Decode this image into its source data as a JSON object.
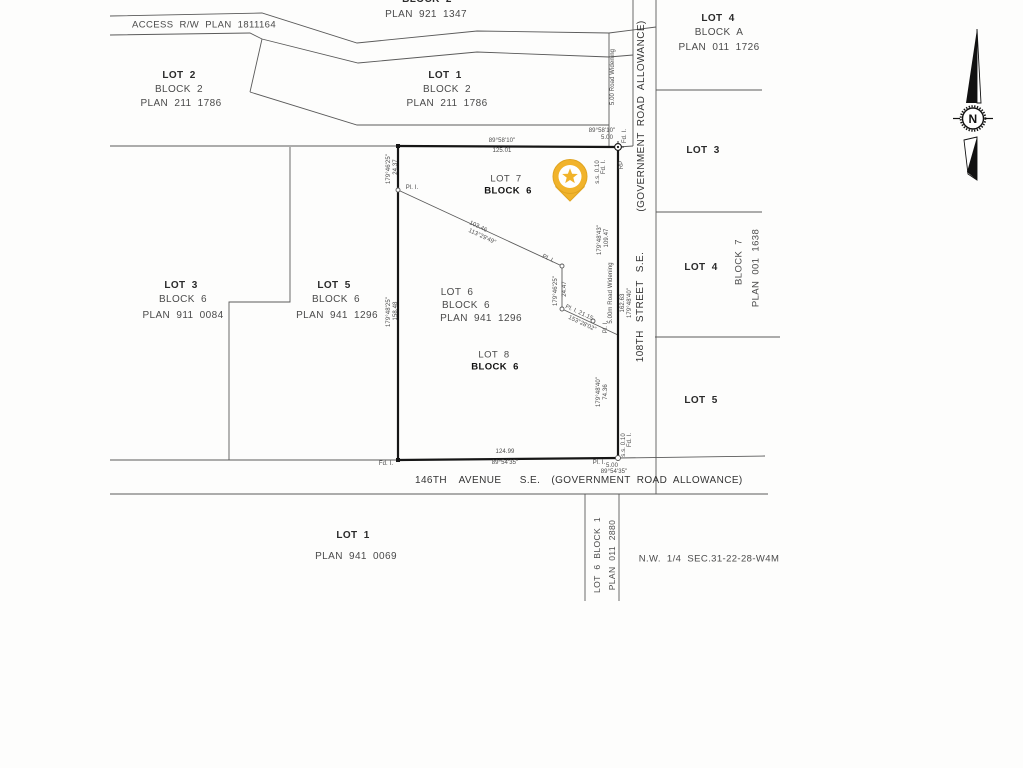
{
  "colors": {
    "thin_line": "#5a5a5a",
    "bold_line": "#161616",
    "text": "#4a4a4a",
    "pin_fill": "#F1B32B",
    "pin_edge": "#E0A420",
    "pin_inner": "#FFFFFF",
    "background": "#fdfdfc"
  },
  "compass": {
    "label": "N"
  },
  "pin": {
    "cx": 570,
    "cy": 176.5,
    "r": 17,
    "inner_r": 11.5,
    "tail": "556,187 584,187 570,201",
    "star": "570,168.3 572.1,173.7 577.8,174 573.3,177.6 574.8,183.1 570,180 565.2,183.1 566.7,177.6 562.2,174 567.9,173.7"
  },
  "geometry": {
    "thin": [
      [
        110,
        16,
        262,
        13,
        357,
        43,
        477,
        31,
        609,
        33,
        656,
        27
      ],
      [
        110,
        35,
        250,
        33,
        262,
        39,
        358,
        63,
        477,
        52,
        609,
        57,
        633,
        55
      ],
      [
        262,
        39,
        250,
        92
      ],
      [
        250,
        92,
        357,
        125,
        609,
        125
      ],
      [
        609,
        33,
        609,
        146
      ],
      [
        633,
        0,
        633,
        146
      ],
      [
        656,
        0,
        656,
        494
      ],
      [
        110,
        146,
        398,
        146
      ],
      [
        290,
        147,
        290,
        302,
        229,
        302,
        229,
        460
      ],
      [
        110,
        460,
        398,
        460
      ],
      [
        618,
        458,
        765,
        456
      ],
      [
        618,
        147,
        633,
        146
      ],
      [
        110,
        494,
        768,
        494
      ],
      [
        585,
        494,
        585,
        601
      ],
      [
        619,
        494,
        619,
        601
      ],
      [
        656,
        90,
        762,
        90
      ],
      [
        656,
        212,
        762,
        212
      ],
      [
        655,
        337,
        780,
        337
      ],
      [
        398,
        190,
        562,
        266,
        562,
        309,
        618,
        335
      ]
    ],
    "bold": [
      [
        398,
        146,
        618,
        147
      ],
      [
        618,
        147,
        618,
        458
      ],
      [
        398,
        460,
        618,
        458
      ],
      [
        398,
        146,
        398,
        460
      ]
    ],
    "circles": [
      [
        398,
        190,
        2
      ],
      [
        562,
        266,
        2
      ],
      [
        562,
        309,
        2
      ],
      [
        593,
        321,
        2
      ],
      [
        618,
        458,
        2.5
      ]
    ],
    "squares": [
      [
        398,
        146
      ],
      [
        398,
        460
      ]
    ],
    "monument": {
      "x": 618,
      "y": 147
    },
    "compass": {
      "top_black": "977,29 966,103 977,103",
      "top_outline": "977,29 981,103 977,103",
      "bottom_outline": "964,140 977,137 977,180 968,174",
      "bottom_black": "977,137 977,180 967,172",
      "circle": {
        "cx": 973,
        "cy": 118.5,
        "r": 10.5,
        "serr_r": 12.3
      },
      "dashes": [
        [
          953,
          118.5,
          960,
          118.5
        ],
        [
          986,
          118.5,
          993,
          118.5
        ]
      ]
    }
  },
  "labels": [
    {
      "n": "block2-top-label",
      "t": "BLOCK 2",
      "x": 427,
      "y": 0,
      "fs": 10,
      "b": 1
    },
    {
      "n": "plan-921-1347-label",
      "t": "PLAN 921 1347",
      "x": 426,
      "y": 15,
      "fs": 10
    },
    {
      "n": "access-rw-label",
      "t": "ACCESS R/W PLAN 1811164",
      "x": 204,
      "y": 25,
      "fs": 9.5
    },
    {
      "n": "lot2-title",
      "t": "LOT 2",
      "x": 179,
      "y": 76,
      "fs": 10,
      "b": 1
    },
    {
      "n": "lot2-block",
      "t": "BLOCK 2",
      "x": 179,
      "y": 89.5,
      "fs": 10
    },
    {
      "n": "lot2-plan",
      "t": "PLAN 211 1786",
      "x": 181,
      "y": 104,
      "fs": 10
    },
    {
      "n": "lot1-title",
      "t": "LOT 1",
      "x": 445,
      "y": 76,
      "fs": 10,
      "b": 1
    },
    {
      "n": "lot1-block",
      "t": "BLOCK 2",
      "x": 447,
      "y": 89.5,
      "fs": 10
    },
    {
      "n": "lot1-plan",
      "t": "PLAN 211 1786",
      "x": 447,
      "y": 104,
      "fs": 10
    },
    {
      "n": "lot4a-title",
      "t": "LOT 4",
      "x": 718,
      "y": 19,
      "fs": 10,
      "b": 1
    },
    {
      "n": "lot4a-block",
      "t": "BLOCK A",
      "x": 719,
      "y": 33,
      "fs": 10
    },
    {
      "n": "lot4a-plan",
      "t": "PLAN 011 1726",
      "x": 719,
      "y": 48,
      "fs": 10
    },
    {
      "n": "lot3-right-title",
      "t": "LOT 3",
      "x": 703,
      "y": 151,
      "fs": 10,
      "b": 1
    },
    {
      "n": "lot4-right-title",
      "t": "LOT 4",
      "x": 701,
      "y": 268,
      "fs": 10,
      "b": 1
    },
    {
      "n": "block7-label",
      "t": "BLOCK 7",
      "x": 739,
      "y": 262,
      "fs": 9.5,
      "r": -90
    },
    {
      "n": "plan-001-1638-label",
      "t": "PLAN 001 1638",
      "x": 756,
      "y": 268,
      "fs": 9.5,
      "r": -90
    },
    {
      "n": "lot5-right-title",
      "t": "LOT 5",
      "x": 701,
      "y": 401,
      "fs": 10,
      "b": 1
    },
    {
      "n": "lot3-title",
      "t": "LOT 3",
      "x": 181,
      "y": 286,
      "fs": 10,
      "b": 1
    },
    {
      "n": "lot3-block",
      "t": "BLOCK 6",
      "x": 183,
      "y": 300,
      "fs": 10
    },
    {
      "n": "lot3-plan",
      "t": "PLAN 911 0084",
      "x": 183,
      "y": 316,
      "fs": 10
    },
    {
      "n": "lot5-title",
      "t": "LOT 5",
      "x": 334,
      "y": 286,
      "fs": 10,
      "b": 1
    },
    {
      "n": "lot5-block",
      "t": "BLOCK 6",
      "x": 336,
      "y": 300,
      "fs": 10
    },
    {
      "n": "lot5-plan",
      "t": "PLAN 941 1296",
      "x": 337,
      "y": 316,
      "fs": 10
    },
    {
      "n": "lot6-title",
      "t": "LOT 6",
      "x": 457,
      "y": 293,
      "fs": 10
    },
    {
      "n": "lot6-block",
      "t": "BLOCK 6",
      "x": 466,
      "y": 306,
      "fs": 10
    },
    {
      "n": "lot6-plan",
      "t": "PLAN 941 1296",
      "x": 481,
      "y": 319,
      "fs": 10
    },
    {
      "n": "lot7-title",
      "t": "LOT 7",
      "x": 506,
      "y": 179,
      "fs": 9.5
    },
    {
      "n": "lot7-block",
      "t": "BLOCK 6",
      "x": 508,
      "y": 191,
      "fs": 9.5,
      "b": 1,
      "c": "#111111"
    },
    {
      "n": "lot8-title",
      "t": "LOT 8",
      "x": 494,
      "y": 355,
      "fs": 9.5
    },
    {
      "n": "lot8-block",
      "t": "BLOCK 6",
      "x": 495,
      "y": 366.5,
      "fs": 9.5,
      "b": 1,
      "c": "#111111"
    },
    {
      "n": "north-bearing",
      "t": "89°58'10\"",
      "x": 502,
      "y": 140.5,
      "fs": 6
    },
    {
      "n": "north-distance",
      "t": "125.01",
      "x": 502,
      "y": 151,
      "fs": 6
    },
    {
      "n": "tr-bearing",
      "t": "89°58'10\"",
      "x": 602,
      "y": 131,
      "fs": 6
    },
    {
      "n": "tr-distance",
      "t": "5.00",
      "x": 607,
      "y": 138,
      "fs": 6
    },
    {
      "n": "tr-fdi-right",
      "t": "Fd. I.",
      "x": 625,
      "y": 136,
      "fs": 6,
      "r": -90
    },
    {
      "n": "tr-rp",
      "t": "RP",
      "x": 622,
      "y": 165,
      "fs": 6,
      "r": -90
    },
    {
      "n": "tr-fdi-left",
      "t": "Fd. I.",
      "x": 604,
      "y": 167,
      "fs": 6,
      "r": -90
    },
    {
      "n": "tr-ss",
      "t": "s.s. 0.10",
      "x": 598,
      "y": 172,
      "fs": 6,
      "r": -90
    },
    {
      "n": "west-bearing-upper",
      "t": "179°46'25\"",
      "x": 389,
      "y": 169,
      "fs": 6,
      "r": -90
    },
    {
      "n": "west-distance-upper",
      "t": "24.37",
      "x": 396,
      "y": 167,
      "fs": 6,
      "r": -90
    },
    {
      "n": "west-bearing-lower",
      "t": "179°48'25\"",
      "x": 389,
      "y": 312,
      "fs": 6,
      "r": -90
    },
    {
      "n": "west-distance-lower",
      "t": "158.48",
      "x": 396,
      "y": 311,
      "fs": 6,
      "r": -90
    },
    {
      "n": "pli-1",
      "t": "Pl. I.",
      "x": 412,
      "y": 188,
      "fs": 6
    },
    {
      "n": "diag1-distance",
      "t": "103.46",
      "x": 478,
      "y": 227,
      "fs": 6,
      "r": 25
    },
    {
      "n": "diag1-bearing",
      "t": "113°29'49\"",
      "x": 482,
      "y": 237,
      "fs": 6,
      "r": 25
    },
    {
      "n": "pli-2",
      "t": "Pl. I.",
      "x": 548,
      "y": 259,
      "fs": 6,
      "r": 25
    },
    {
      "n": "jog-bearing",
      "t": "179°46'25\"",
      "x": 556,
      "y": 291,
      "fs": 6,
      "r": -90
    },
    {
      "n": "jog-distance",
      "t": "24.47",
      "x": 565,
      "y": 289,
      "fs": 6,
      "r": -90
    },
    {
      "n": "diag2-label",
      "t": "Pl. I. 21.15",
      "x": 579,
      "y": 313,
      "fs": 6,
      "r": 25
    },
    {
      "n": "diag2-bearing",
      "t": "153°28'02\"",
      "x": 582,
      "y": 324,
      "fs": 6,
      "r": 25
    },
    {
      "n": "pli-3",
      "t": "Pl. I.",
      "x": 606,
      "y": 327,
      "fs": 6,
      "r": -90
    },
    {
      "n": "east-bearing-upper",
      "t": "179°48'43\"",
      "x": 600,
      "y": 240,
      "fs": 6,
      "r": -90
    },
    {
      "n": "east-distance-upper",
      "t": "109.47",
      "x": 607,
      "y": 238,
      "fs": 6,
      "r": -90
    },
    {
      "n": "road-widening-top",
      "t": "5.00 Road Widening",
      "x": 613,
      "y": 77,
      "fs": 6,
      "r": -90
    },
    {
      "n": "road-widening-mid",
      "t": "5.00m Road Widening",
      "x": 611,
      "y": 293,
      "fs": 6,
      "r": -90
    },
    {
      "n": "street-distance",
      "t": "162.63",
      "x": 623,
      "y": 303,
      "fs": 6,
      "r": -90
    },
    {
      "n": "street-bearing",
      "t": "179°48'40\"",
      "x": 629.5,
      "y": 303,
      "fs": 6,
      "r": -90
    },
    {
      "n": "east-bearing-lower",
      "t": "179°48'40\"",
      "x": 599,
      "y": 392,
      "fs": 6,
      "r": -90
    },
    {
      "n": "east-distance-lower",
      "t": "74.36",
      "x": 606,
      "y": 392,
      "fs": 6,
      "r": -90
    },
    {
      "n": "br-fdi",
      "t": "Fd. I.",
      "x": 630,
      "y": 440,
      "fs": 6,
      "r": -90
    },
    {
      "n": "br-ss",
      "t": "s.s. 0.10",
      "x": 624,
      "y": 445,
      "fs": 6,
      "r": -90
    },
    {
      "n": "south-distance",
      "t": "124.99",
      "x": 505,
      "y": 452,
      "fs": 6
    },
    {
      "n": "south-bearing",
      "t": "89°54'35\"",
      "x": 505,
      "y": 463,
      "fs": 6
    },
    {
      "n": "bl-fdi",
      "t": "Fd. I.",
      "x": 386,
      "y": 464,
      "fs": 6
    },
    {
      "n": "br-pli",
      "t": "Pl. I.",
      "x": 599,
      "y": 462.5,
      "fs": 6
    },
    {
      "n": "br-distance",
      "t": "5.00",
      "x": 612,
      "y": 465.5,
      "fs": 6
    },
    {
      "n": "br-bearing",
      "t": "89°54'35\"",
      "x": 614,
      "y": 472,
      "fs": 6
    },
    {
      "n": "ave-146th",
      "t": "146TH",
      "x": 431,
      "y": 481,
      "fs": 10,
      "c": "#333333"
    },
    {
      "n": "ave-avenue",
      "t": "AVENUE",
      "x": 480,
      "y": 481,
      "fs": 10,
      "c": "#333333"
    },
    {
      "n": "ave-se",
      "t": "S.E.",
      "x": 530,
      "y": 481,
      "fs": 10,
      "c": "#333333"
    },
    {
      "n": "ave-gov-allowance",
      "t": "(GOVERNMENT ROAD ALLOWANCE)",
      "x": 647,
      "y": 481,
      "fs": 10,
      "c": "#333333"
    },
    {
      "n": "lot1b-title",
      "t": "LOT 1",
      "x": 353,
      "y": 536,
      "fs": 10,
      "b": 1
    },
    {
      "n": "lot1b-plan",
      "t": "PLAN 941 0069",
      "x": 356,
      "y": 557,
      "fs": 10
    },
    {
      "n": "strip-lot-label",
      "t": "LOT 6 BLOCK 1",
      "x": 597,
      "y": 555,
      "fs": 8.5,
      "r": -90
    },
    {
      "n": "strip-plan-label",
      "t": "PLAN 011 2880",
      "x": 612,
      "y": 555,
      "fs": 8.5,
      "r": -90
    },
    {
      "n": "quarter-section-label",
      "t": "N.W. 1/4 SEC.31-22-28-W4M",
      "x": 709,
      "y": 559,
      "fs": 9.5
    },
    {
      "n": "gov-allowance-right",
      "t": "(GOVERNMENT ROAD ALLOWANCE)",
      "x": 642,
      "y": 116,
      "fs": 10,
      "r": -90,
      "c": "#333333"
    },
    {
      "n": "street-108th",
      "t": "108TH STREET S.E.",
      "x": 641,
      "y": 307,
      "fs": 10,
      "r": -90,
      "ws": 5,
      "c": "#333333"
    },
    {
      "n": "compass-n-label",
      "t": "N",
      "x": 973,
      "y": 118.5,
      "fs": 12,
      "b": 1,
      "c": "#111111"
    }
  ]
}
